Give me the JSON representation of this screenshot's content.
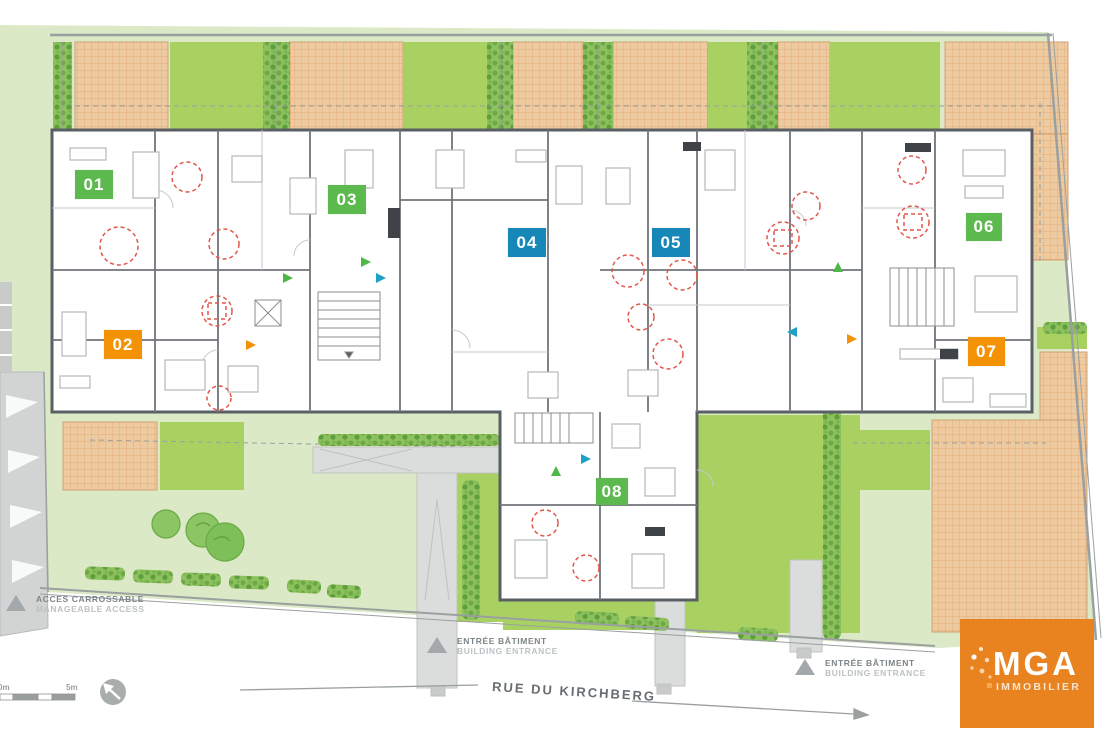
{
  "title": "Residential site / floor plan",
  "street_label": "RUE DU KIRCHBERG",
  "units": [
    {
      "number": "01",
      "color": "#5cb94d"
    },
    {
      "number": "02",
      "color": "#f39204"
    },
    {
      "number": "03",
      "color": "#5cb94d"
    },
    {
      "number": "04",
      "color": "#1787b8"
    },
    {
      "number": "05",
      "color": "#1787b8"
    },
    {
      "number": "06",
      "color": "#5cb94d"
    },
    {
      "number": "07",
      "color": "#f39204"
    },
    {
      "number": "08",
      "color": "#5cb94d"
    }
  ],
  "legend": [
    {
      "fr": "ACCES CARROSSABLE",
      "en": "MANAGEABLE ACCESS",
      "icon": "triangle-marker-icon"
    },
    {
      "fr": "ENTRÉE BÂTIMENT",
      "en": "BUILDING ENTRANCE",
      "icon": "triangle-marker-icon"
    },
    {
      "fr": "ENTRÉE BÂTIMENT",
      "en": "BUILDING ENTRANCE",
      "icon": "triangle-marker-icon"
    }
  ],
  "scale": {
    "start_label": "0m",
    "end_label": "5m"
  },
  "compass": {
    "icon": "north-arrow-compass-icon",
    "direction": "north-west"
  },
  "logo": {
    "name": "MGA",
    "sub": "IMMOBILIER",
    "background": "#e8831f"
  },
  "colors": {
    "lawn": "#dbe9c6",
    "garden": "#a9d162",
    "terrace": "#eecaa0",
    "terrace_grid": "#dfa46c",
    "hedge": "#6da843",
    "wall": "#5a5f63",
    "path": "#dbdddc",
    "red_marker": "#e2574b",
    "unit_green": "#5cb94d",
    "unit_orange": "#f39204",
    "unit_blue": "#1787b8"
  },
  "markers": {
    "red_dashed_circles_count": 15,
    "entrance_arrow_colors": [
      "#4db848",
      "#1fa0c8",
      "#f39204"
    ]
  }
}
